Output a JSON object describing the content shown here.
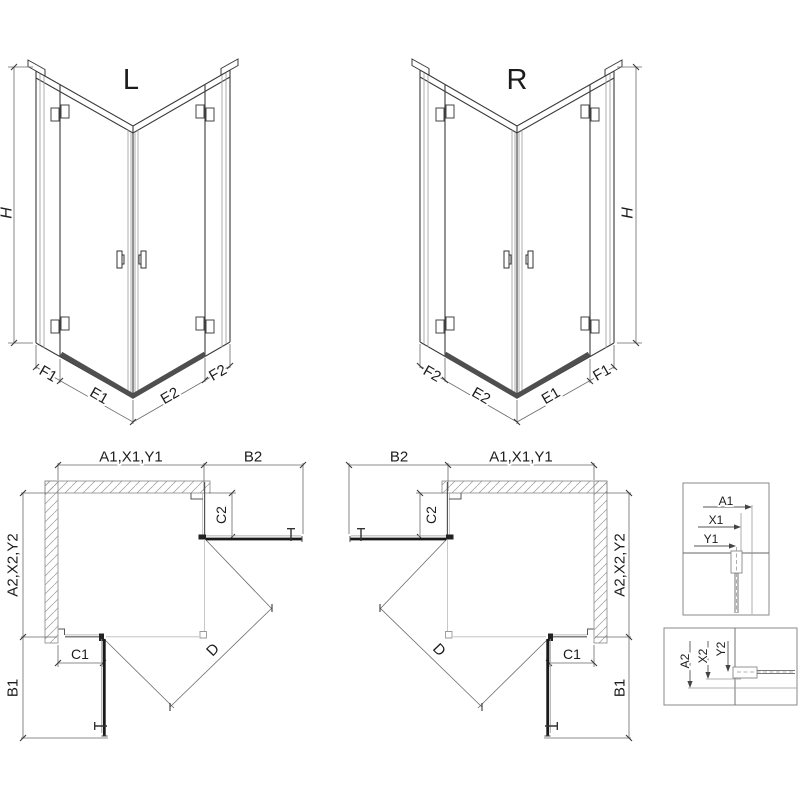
{
  "drawing": {
    "iso_left": {
      "title": "L",
      "height": "H",
      "seg1": "F1",
      "seg2": "E1",
      "seg3": "E2",
      "seg4": "F2"
    },
    "iso_right": {
      "title": "R",
      "height": "H",
      "seg1": "F2",
      "seg2": "E2",
      "seg3": "E1",
      "seg4": "F1"
    },
    "plan_left": {
      "width_top": "A1,X1,Y1",
      "door_top": "B2",
      "height_side": "A2,X2,Y2",
      "door_side": "B1",
      "fixed_top": "C2",
      "fixed_side": "C1",
      "diagonal": "D"
    },
    "plan_right": {
      "width_top": "A1,X1,Y1",
      "door_top": "B2",
      "height_side": "A2,X2,Y2",
      "door_side": "B1",
      "fixed_top": "C2",
      "fixed_side": "C1",
      "diagonal": "D"
    },
    "detail_top": {
      "dim1": "A1",
      "dim2": "X1",
      "dim3": "Y1"
    },
    "detail_bottom": {
      "dim1": "A2",
      "dim2": "X2",
      "dim3": "Y2"
    }
  },
  "colors": {
    "background": "#ffffff",
    "frame_line": "#3a3a3a",
    "glass_line": "#9a9a9a",
    "dimension_line": "#6a6a6a",
    "threshold": "#4f4f4f",
    "open_door": "#1a1a1a"
  }
}
